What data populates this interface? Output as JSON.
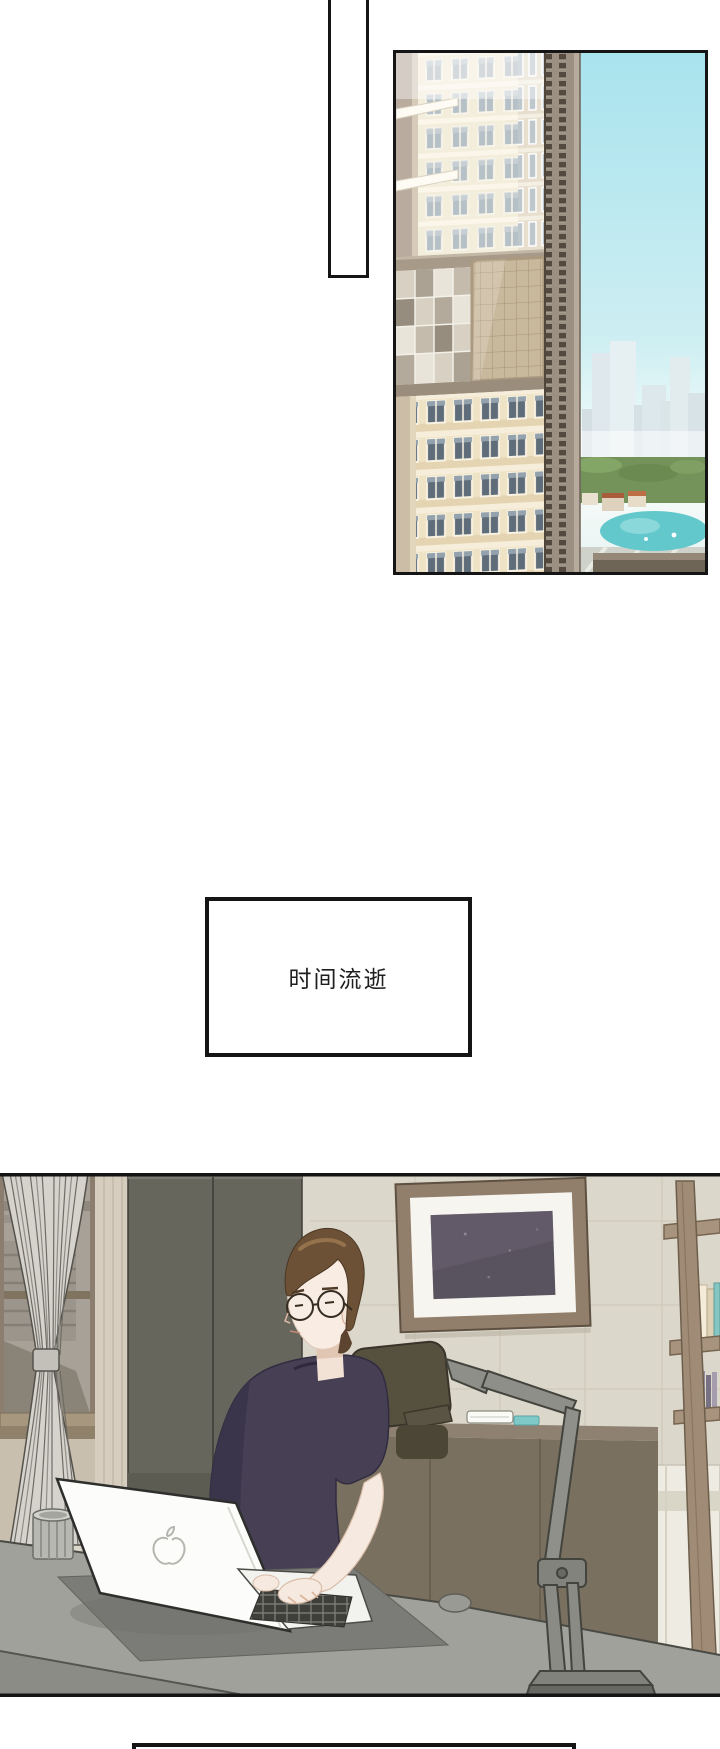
{
  "page": {
    "kind": "webtoon comic page",
    "width": 720,
    "height": 1749,
    "background": "#ffffff"
  },
  "caption": {
    "text": "时间流逝"
  },
  "panels": [
    {
      "name": "empty-vertical-panel"
    },
    {
      "name": "cityscape-panel",
      "subject": "high-rise towers over a bay-side city under a clear sky"
    },
    {
      "name": "caption-panel",
      "text": "时间流逝"
    },
    {
      "name": "home-office-scene",
      "subject": "man with round glasses typing on a white laptop at a desk",
      "objects": [
        "window",
        "striped-curtain",
        "wardrobe",
        "framed-picture",
        "ladder-bookshelf",
        "sideboard",
        "office-chair",
        "man-with-glasses",
        "macbook-laptop",
        "apple-logo",
        "coffee-mug",
        "desk-mat",
        "computer-mouse",
        "desk-lamp"
      ]
    },
    {
      "name": "bottom-panel-partial"
    }
  ],
  "palette": {
    "panel_border": "#151515",
    "sky": "#aee4ee",
    "sky_haze": "#f2fbfa",
    "water": "#63c8cc",
    "park_green": "#74935a",
    "building_cream": "#f3eddc",
    "building_lower": "#efe3c6",
    "tower_strip": "#9c9083",
    "window_glass": "#b6c0c7",
    "glass_curtainwall": "#c8b89c",
    "room_wall": "#dcd7cb",
    "wardrobe": "#67665d",
    "curtain": "#d6d3cd",
    "frame_wood": "#917f6b",
    "art": "#59525f",
    "shelf_wood": "#a08b76",
    "book_cream": "#ecdfbf",
    "book_teal": "#86c6c2",
    "desk": "#a1a19c",
    "desk_mat": "#7b7b77",
    "laptop": "#fcfcfa",
    "shirt": "#474055",
    "hair": "#6d5137",
    "skin": "#f8ece3",
    "lamp": "#8f8f89",
    "sideboard": "#7a7060",
    "chair": "#56503e",
    "mug": "#b8b8b3",
    "teal_item": "#7fc9c9"
  }
}
